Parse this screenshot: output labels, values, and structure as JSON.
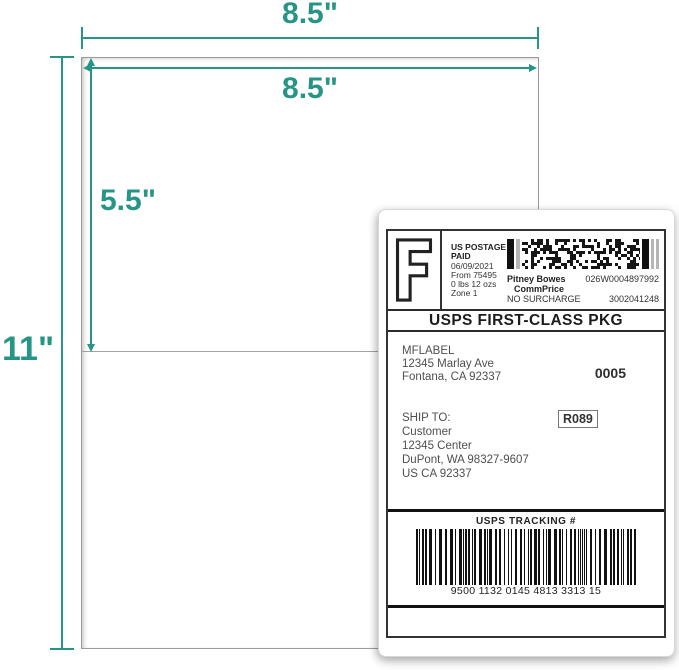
{
  "accent_color": "#279586",
  "dimensions": {
    "sheet_width_label": "8.5\"",
    "label_width_label": "8.5\"",
    "label_height_label": "5.5\"",
    "sheet_height_label": "11\""
  },
  "shipping_label": {
    "indicia": {
      "letter": "F",
      "postage_line1": "US POSTAGE",
      "postage_line2": "PAID",
      "date": "06/09/2021",
      "origin": "From 75495",
      "weight": "0 lbs 12 ozs",
      "zone": "Zone 1",
      "carrier": "Pitney Bowes",
      "meter_number": "026W0004897992",
      "rate_class": "CommPrice",
      "surcharge": "NO SURCHARGE",
      "account_number": "3002041248"
    },
    "service": "USPS FIRST-CLASS PKG",
    "from_address": {
      "name": "MFLABEL",
      "street": "12345 Marlay Ave",
      "city": "Fontana, CA 92337"
    },
    "batch_number": "0005",
    "ship_to": {
      "heading": "SHIP TO:",
      "name": "Customer",
      "street": "12345 Center",
      "city": "DuPont, WA 98327-9607",
      "country": "US CA 92337"
    },
    "route_code": "R089",
    "tracking": {
      "heading": "USPS TRACKING #",
      "number": "9500 1132 0145 4813 3313 15"
    }
  }
}
